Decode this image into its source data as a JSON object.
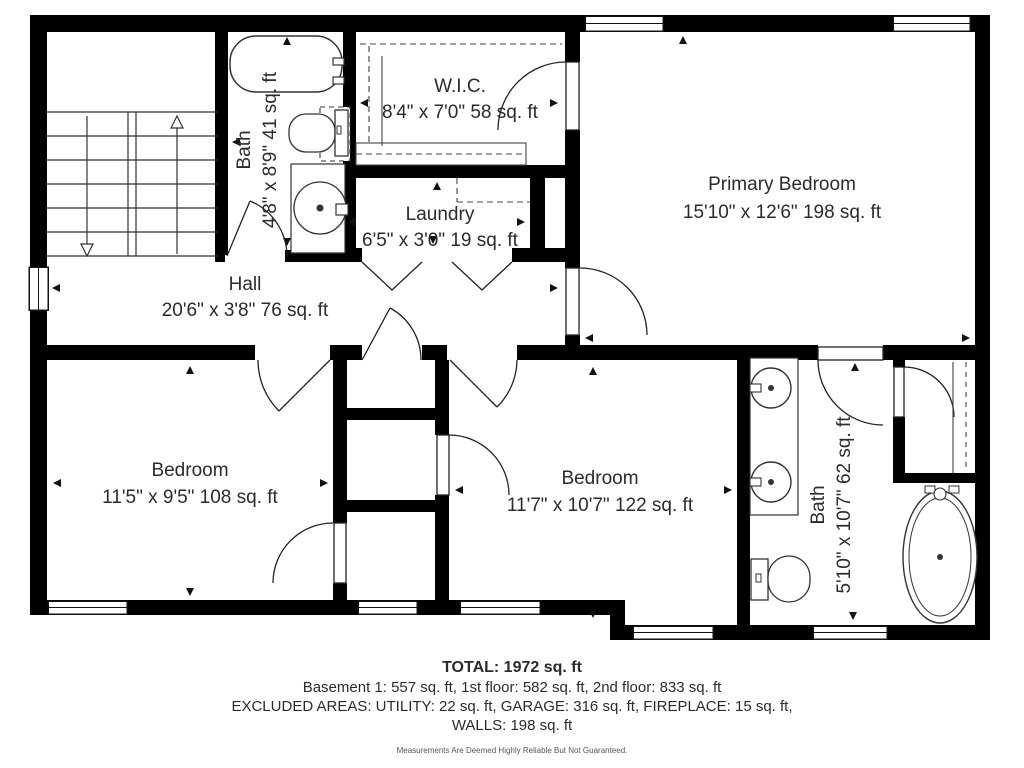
{
  "rooms": {
    "wic": {
      "name": "W.I.C.",
      "dims": "8'4\" x 7'0\" 58 sq. ft"
    },
    "primary_bedroom": {
      "name": "Primary Bedroom",
      "dims": "15'10\" x 12'6\" 198 sq. ft"
    },
    "bath_upper": {
      "name": "Bath",
      "dims": "4'8\" x 8'9\" 41 sq. ft"
    },
    "laundry": {
      "name": "Laundry",
      "dims": "6'5\" x 3'0\" 19 sq. ft"
    },
    "hall": {
      "name": "Hall",
      "dims": "20'6\" x 3'8\" 76 sq. ft"
    },
    "bedroom_left": {
      "name": "Bedroom",
      "dims": "11'5\" x 9'5\" 108 sq. ft"
    },
    "bedroom_right": {
      "name": "Bedroom",
      "dims": "11'7\" x 10'7\" 122 sq. ft"
    },
    "bath_lower": {
      "name": "Bath",
      "dims": "5'10\" x 10'7\" 62 sq. ft"
    }
  },
  "footer": {
    "total": "TOTAL: 1972 sq. ft",
    "floors": "Basement 1: 557 sq. ft, 1st floor: 582 sq. ft, 2nd floor: 833 sq. ft",
    "excluded": "EXCLUDED AREAS: UTILITY: 22 sq. ft, GARAGE: 316 sq. ft, FIREPLACE: 15 sq. ft,",
    "walls": "WALLS: 198 sq. ft",
    "disclaimer": "Measurements Are Deemed Highly Reliable But Not Guaranteed."
  },
  "colors": {
    "wall": "#000000",
    "line": "#2a2a2a",
    "text": "#2b2b2b",
    "background": "#ffffff"
  }
}
